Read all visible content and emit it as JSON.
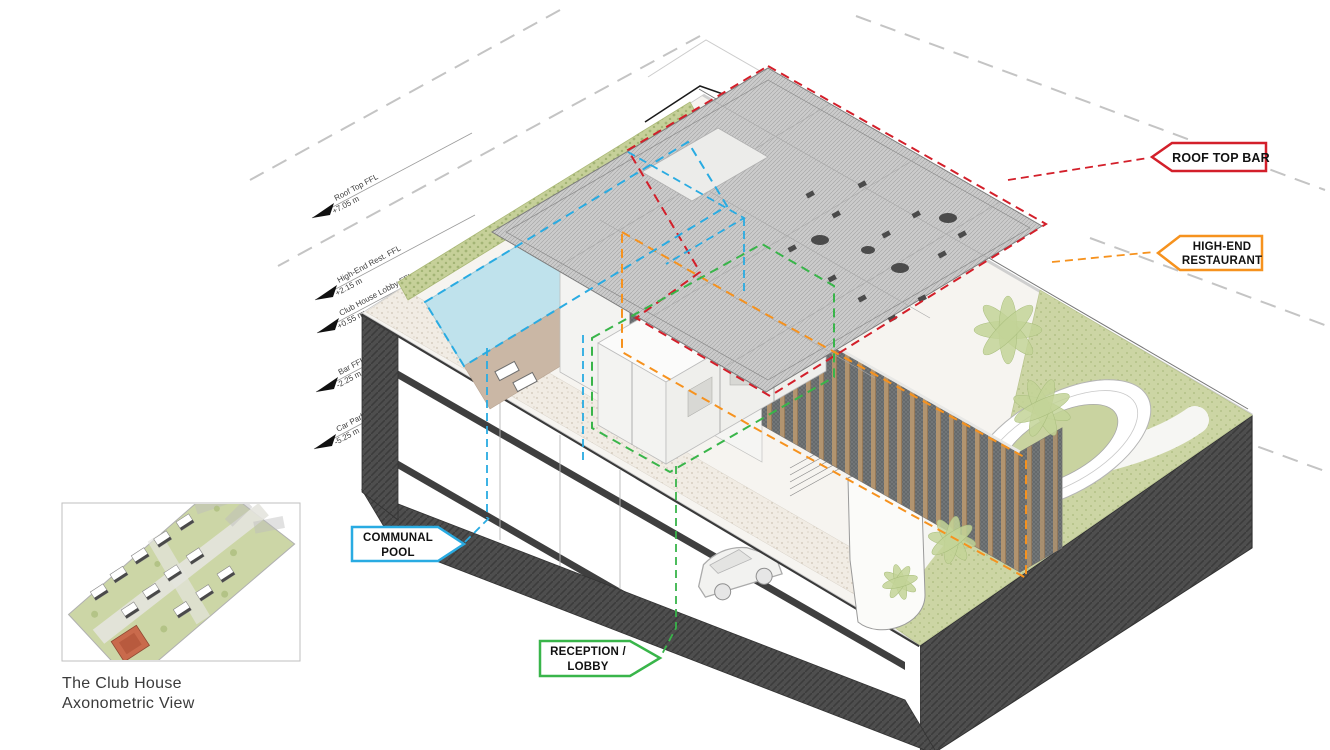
{
  "caption": {
    "line1": "The Club House",
    "line2": "Axonometric View"
  },
  "callouts": {
    "roof_top_bar": {
      "label": "ROOF TOP BAR",
      "color": "#d31f2a"
    },
    "high_end_restaurant": {
      "line1": "HIGH-END",
      "line2": "RESTAURANT",
      "color": "#f6921e"
    },
    "communal_pool": {
      "line1": "COMMUNAL",
      "line2": "POOL",
      "color": "#29abe2"
    },
    "reception_lobby": {
      "line1": "RECEPTION /",
      "line2": "LOBBY",
      "color": "#39b54a"
    }
  },
  "levels": [
    {
      "name": "Roof Top FFL",
      "elevation": "+7.05 m"
    },
    {
      "name": "High-End Rest. FFL",
      "elevation": "+2.15 m"
    },
    {
      "name": "Club House Lobby FFL",
      "elevation": "+0.55 m"
    },
    {
      "name": "Bar FFL",
      "elevation": "-2.25 m"
    },
    {
      "name": "Car Park FFL",
      "elevation": "-5.25 m"
    }
  ],
  "drawing_colors": {
    "pool_water": "#bfe2ec",
    "deck": "#cab7a5",
    "lawn": "#ccd5a4",
    "hedge": "#c6d099",
    "louver": "#b2946f",
    "podium_dark": "#4e4e4e",
    "boundary_dash": "#c4c4c4"
  }
}
